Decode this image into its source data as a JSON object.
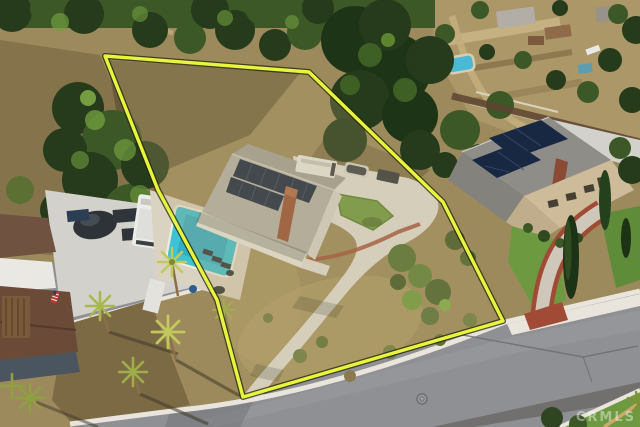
{
  "meta": {
    "description": "Aerial drone photo of a hillside residential property outlined in yellow: a single-story house with rooftop solar panels, swimming pool and long curved concrete driveway on a dry brush lot, with neighboring homes, an RV pad, palm trees and a street across the bottom."
  },
  "watermark": {
    "text": "CRMLS"
  },
  "boundary": {
    "label": "property-lot-outline",
    "points": "105,56 309,72 443,202 503,321 243,397 217,300 158,190"
  },
  "palette": {
    "boundary_yellow": "#e7f63d",
    "boundary_shadow": "#23230f",
    "pool_water": "#3ec3d4",
    "pool_deep": "#2795b5",
    "neighbor_pool": "#49b9d6",
    "solar": "#182742",
    "roof_gray": "#b4b2ac",
    "neighbor_roof": "#8f8d88",
    "wall_white": "#eae8e2",
    "wall_tan": "#cdbb9a",
    "chimney": "#9a5136",
    "concrete": "#e2e0d9",
    "concrete_pad": "#d3d1cc",
    "curb": "#e9e5dc",
    "asphalt": "#8f9094",
    "asphalt_dark": "#77787c",
    "brush": "#9c8a5c",
    "brush_light": "#b3a06c",
    "dirt": "#7c6a45",
    "shadow": "#4c3f28",
    "tree_dark": "#263b1b",
    "tree_mid": "#3c5826",
    "tree_light": "#6f9c3e",
    "palm": "#b9c35a",
    "lawn": "#6d9a40",
    "brick": "#a14b36",
    "rv": "#ecece8",
    "vehicle_dark": "#30353b",
    "watermark": "#ffffff"
  }
}
